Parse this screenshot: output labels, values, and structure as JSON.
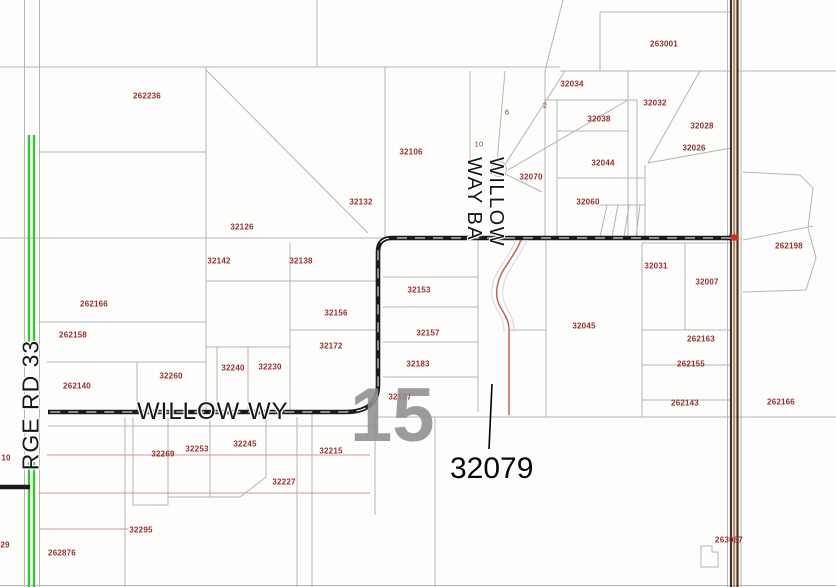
{
  "colors": {
    "line_gray": "#b5b5b5",
    "line_pink": "#cf9d9d",
    "label_red": "#9b2c2c",
    "road_black": "#1a1a1a",
    "road_green": "#3cc335",
    "road_brown": "#46301f",
    "road_brown_center": "#a8876a",
    "utility_red": "#c2605c",
    "marker_red": "#d03020",
    "section_gray": "#8f8f8f"
  },
  "map": {
    "parcel_labels": [
      {
        "text": "262236",
        "x": 147,
        "y": 96
      },
      {
        "text": "263001",
        "x": 664,
        "y": 44
      },
      {
        "text": "32034",
        "x": 572,
        "y": 84
      },
      {
        "text": "32032",
        "x": 655,
        "y": 103
      },
      {
        "text": "32038",
        "x": 599,
        "y": 119
      },
      {
        "text": "32028",
        "x": 702,
        "y": 126
      },
      {
        "text": "32026",
        "x": 694,
        "y": 148
      },
      {
        "text": "32044",
        "x": 603,
        "y": 163
      },
      {
        "text": "32060",
        "x": 588,
        "y": 202
      },
      {
        "text": "32106",
        "x": 411,
        "y": 152
      },
      {
        "text": "32070",
        "x": 531,
        "y": 177
      },
      {
        "text": "32132",
        "x": 361,
        "y": 202
      },
      {
        "text": "32126",
        "x": 242,
        "y": 227
      },
      {
        "text": "32142",
        "x": 219,
        "y": 261
      },
      {
        "text": "32138",
        "x": 301,
        "y": 261
      },
      {
        "text": "262198",
        "x": 789,
        "y": 246
      },
      {
        "text": "32031",
        "x": 656,
        "y": 266
      },
      {
        "text": "32007",
        "x": 707,
        "y": 282
      },
      {
        "text": "32153",
        "x": 419,
        "y": 290
      },
      {
        "text": "262166",
        "x": 94,
        "y": 304
      },
      {
        "text": "32156",
        "x": 336,
        "y": 313
      },
      {
        "text": "262158",
        "x": 73,
        "y": 335
      },
      {
        "text": "32045",
        "x": 584,
        "y": 326
      },
      {
        "text": "32157",
        "x": 428,
        "y": 333
      },
      {
        "text": "262163",
        "x": 701,
        "y": 339
      },
      {
        "text": "32172",
        "x": 331,
        "y": 346
      },
      {
        "text": "262155",
        "x": 691,
        "y": 364
      },
      {
        "text": "32183",
        "x": 418,
        "y": 364
      },
      {
        "text": "32240",
        "x": 233,
        "y": 368
      },
      {
        "text": "32230",
        "x": 270,
        "y": 367
      },
      {
        "text": "32260",
        "x": 171,
        "y": 376
      },
      {
        "text": "262140",
        "x": 77,
        "y": 386
      },
      {
        "text": "32187",
        "x": 400,
        "y": 397
      },
      {
        "text": "262143",
        "x": 685,
        "y": 403
      },
      {
        "text": "262166",
        "x": 781,
        "y": 402
      },
      {
        "text": "32245",
        "x": 245,
        "y": 444
      },
      {
        "text": "32253",
        "x": 197,
        "y": 449
      },
      {
        "text": "32269",
        "x": 163,
        "y": 454
      },
      {
        "text": "32215",
        "x": 331,
        "y": 451
      },
      {
        "text": "32227",
        "x": 284,
        "y": 482
      },
      {
        "text": "32295",
        "x": 141,
        "y": 530
      },
      {
        "text": "263087",
        "x": 729,
        "y": 540
      },
      {
        "text": "262876",
        "x": 62,
        "y": 553
      }
    ],
    "lot_labels": [
      {
        "text": "6",
        "x": 507,
        "y": 112
      },
      {
        "text": "2",
        "x": 545,
        "y": 105
      },
      {
        "text": "10",
        "x": 479,
        "y": 144
      }
    ],
    "partial_labels": [
      {
        "text": "10",
        "x": 6,
        "y": 458
      },
      {
        "text": "29",
        "x": 5,
        "y": 545
      }
    ],
    "road_labels": {
      "rge_rd": "RGE RD 33",
      "willow_wy": "WILLOW WY",
      "willow_way_ba_line1": "WILLOW",
      "willow_way_ba_line2": "WAY BA"
    },
    "section_number": "15",
    "callout_label": "32079"
  }
}
